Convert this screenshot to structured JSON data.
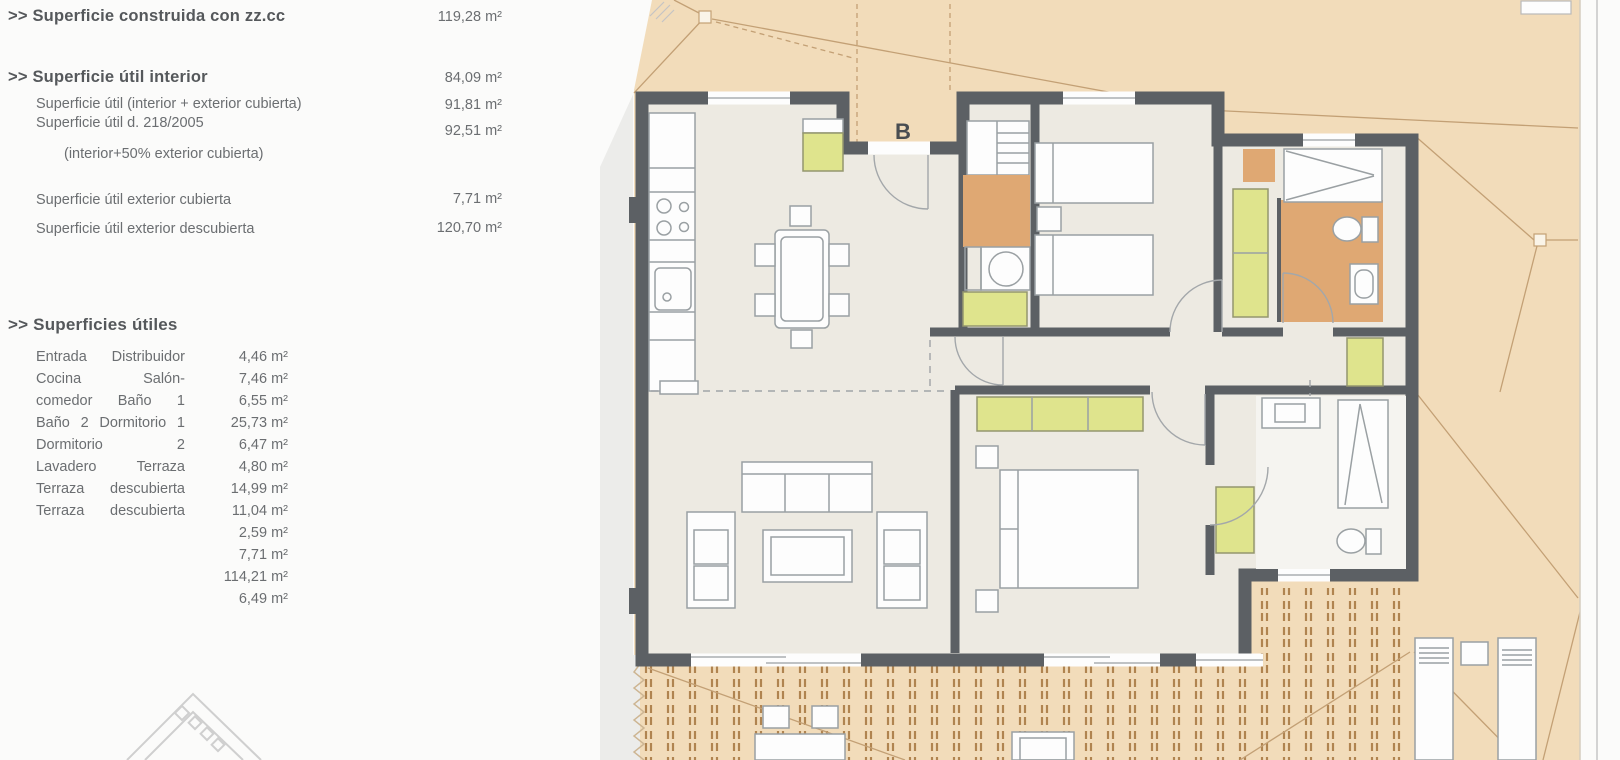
{
  "panel": {
    "summary": [
      {
        "label": ">> Superficie construida con zz.cc",
        "value": "119,28 m²"
      },
      {
        "label": ">> Superficie útil interior",
        "value": "84,09 m²"
      },
      {
        "label": "Superficie útil (interior + exterior cubierta)",
        "value": "91,81 m²"
      },
      {
        "label": "Superficie útil d. 218/2005",
        "value": "92,51 m²"
      },
      {
        "label": "(interior+50% exterior cubierta)",
        "value": ""
      },
      {
        "label": "Superficie útil exterior cubierta",
        "value": "7,71 m²"
      },
      {
        "label": "Superficie útil exterior descubierta",
        "value": "120,70 m²"
      }
    ],
    "section_title": ">> Superficies útiles",
    "useful_areas": [
      {
        "label": "Entrada Distribuidor",
        "value": "4,46 m²"
      },
      {
        "label": "Cocina Salón-",
        "value": "7,46 m²"
      },
      {
        "label": "comedor Baño 1",
        "value": "6,55 m²"
      },
      {
        "label": "Baño 2 Dormitorio 1",
        "value": "25,73 m²"
      },
      {
        "label": "Dormitorio 2",
        "value": "6,47 m²"
      },
      {
        "label": "Lavadero Terraza",
        "value": "4,80 m²"
      },
      {
        "label": "Terraza descubierta",
        "value": "14,99 m²"
      },
      {
        "label": "Terraza descubierta",
        "value": "11,04 m²"
      },
      {
        "label": "",
        "value": "2,59 m²"
      },
      {
        "label": "",
        "value": "7,71 m²"
      },
      {
        "label": "",
        "value": "114,21 m²"
      },
      {
        "label": "",
        "value": "6,49 m²"
      }
    ]
  },
  "plan": {
    "entrance_label": "B"
  },
  "colors": {
    "sheet": "#fbfbfa",
    "wedge": "#ececea",
    "roof": "#f2dcba",
    "roof_line": "#c3a075",
    "deck_line": "#b08450",
    "wall": "#5c6064",
    "floor": "#edeae2",
    "room_white": "#fdfdfd",
    "wardrobe_yellow": "#dfe48d",
    "wardrobe_stroke": "#94966e",
    "bath_orange": "#dfa873",
    "bath2_floor": "#f5f4f0",
    "furniture_line": "#9aa0a3",
    "text": "#6b6e71",
    "label_dark": "#55585b",
    "entrance_letter": "#494d51"
  }
}
